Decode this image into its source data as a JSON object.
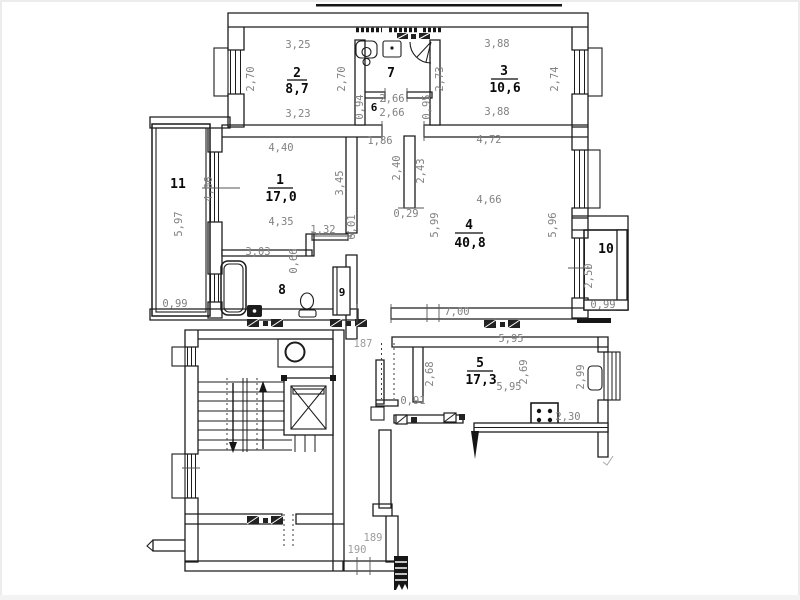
{
  "plan": {
    "title": "apartment-floor-plan",
    "colors": {
      "wall": "#1c1c1c",
      "dim_text": "#818181",
      "room_text": "#0a0a0a",
      "hall_text": "#9c9c9c"
    },
    "rooms": {
      "r1": {
        "num": "1",
        "area": "17,0"
      },
      "r2": {
        "num": "2",
        "area": "8,7"
      },
      "r3": {
        "num": "3",
        "area": "10,6"
      },
      "r4": {
        "num": "4",
        "area": "40,8"
      },
      "r5": {
        "num": "5",
        "area": "17,3"
      },
      "r6": {
        "num": "6"
      },
      "r7": {
        "num": "7"
      },
      "r8": {
        "num": "8"
      },
      "r9": {
        "num": "9"
      },
      "r10": {
        "num": "10"
      },
      "r11": {
        "num": "11"
      }
    },
    "dims": {
      "r2_top": "3,25",
      "r2_left": "2,70",
      "r2_right": "2,70",
      "r2_bottom": "3,23",
      "r6_top": "2,66",
      "r6_bottom": "2,66",
      "r6_left": "0,94",
      "r6_right": "0,95",
      "r3_top": "3,88",
      "r3_left": "2,73",
      "r3_right": "2,74",
      "r3_bottom": "3,88",
      "r1_top": "4,40",
      "r1_mid": "4,35",
      "r1_right": "3,45",
      "r1_b1": "3,03",
      "r1_b2": "0,66",
      "r1_door": "1,32",
      "corr_len": "6,01",
      "r4_t1": "1,86",
      "r4_t2": "4,72",
      "r4_p1": "2,40",
      "r4_p2": "2,43",
      "r4_p3": "0,29",
      "r4_left": "5,99",
      "r4_mid": "4,66",
      "r4_right": "5,96",
      "r4_bottom": "7,00",
      "r11_len": "5,97",
      "r11_wall": "4,06",
      "r11_w": "0,99",
      "r10_len": "2,50",
      "r10_w": "0,99",
      "r5_top": "5,95",
      "r5_left": "2,68",
      "r5_mid": "2,69",
      "r5_bottom": "5,95",
      "r5_right": "2,99",
      "r5_nook": "0,91",
      "r5_counter": "2,30",
      "h187": "187",
      "h189": "189",
      "h190": "190"
    }
  }
}
